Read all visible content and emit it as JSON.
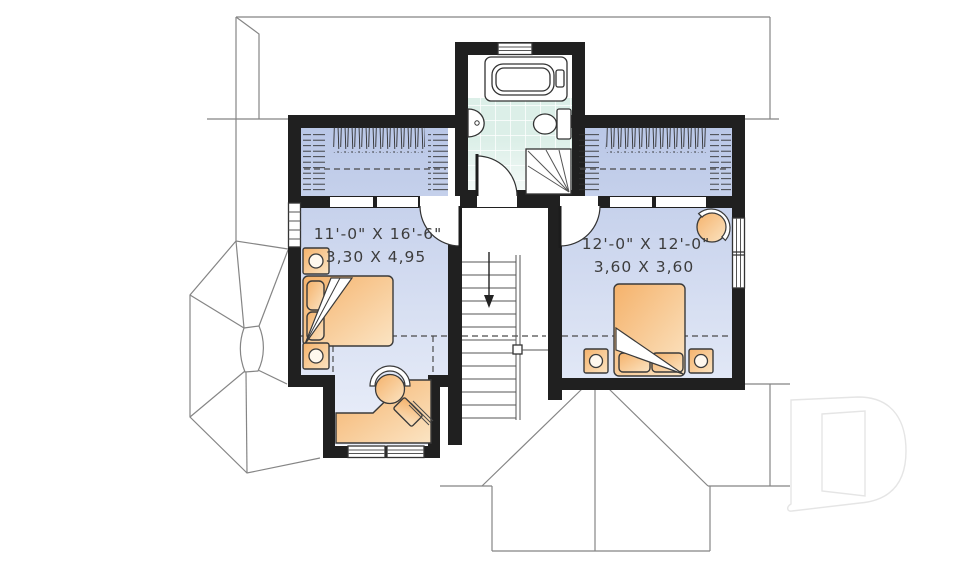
{
  "plan": {
    "type": "second-floor-house-plan",
    "rooms": [
      {
        "name": "bedroom-left",
        "imperial": "11'-0\" X 16'-6\"",
        "metric": "3,30 X 4,95"
      },
      {
        "name": "bedroom-right",
        "imperial": "12'-0\" X 12'-0\"",
        "metric": "3,60 X 3,60"
      }
    ],
    "features": [
      "bathtub",
      "pedestal-sink",
      "toilet",
      "corner-shower",
      "tiled-bathroom-floor",
      "closet-left-with-hanging-rod",
      "closet-right-with-hanging-rod",
      "stairs-down-arrow",
      "double-bed-left",
      "double-bed-right",
      "nightstands-with-lamps",
      "corner-desk",
      "desk-chair",
      "laptop",
      "round-armchair",
      "windows",
      "roof-outline",
      "bay-window-roof",
      "dormer-roof"
    ],
    "watermark": "D",
    "colors": {
      "wall": "#202020",
      "bedroom_floor_dark": "#b7c5e6",
      "bedroom_floor_light": "#eef2fb",
      "bathroom_tile": "#dcefe8",
      "furniture_dark": "#f5b26b",
      "furniture_light": "#fbe4c3",
      "roof_line": "#858585",
      "label_text": "#3d3d3d",
      "watermark": "#e5e5e5"
    }
  }
}
